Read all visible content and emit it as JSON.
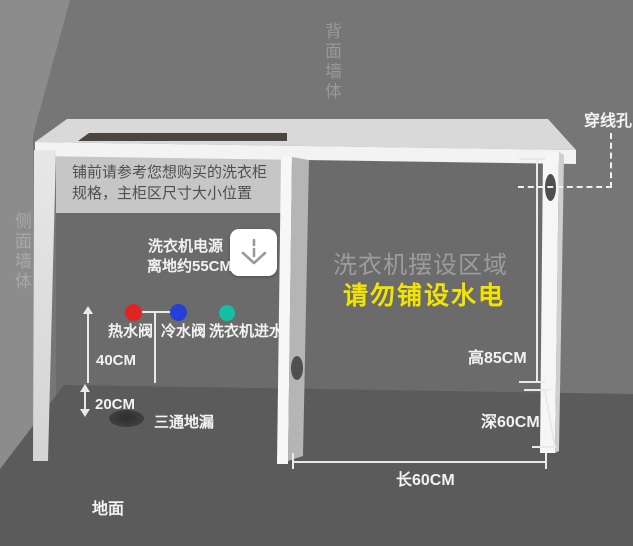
{
  "walls": {
    "back_label": "背面墙体",
    "side_label": "侧面墙体",
    "floor_label": "地面"
  },
  "notice": {
    "text": "铺前请参考您想购买的洗衣柜规格，主柜区尺寸大小位置"
  },
  "power": {
    "line1": "洗衣机电源",
    "line2": "离地约55CM",
    "icon": "plug-down-arrow-icon"
  },
  "valves": {
    "hot": {
      "label": "热水阀",
      "color": "#e02421"
    },
    "cold": {
      "label": "冷水阀",
      "color": "#2440d8"
    },
    "inlet": {
      "label": "洗衣机进水阀",
      "color": "#14bfa6"
    }
  },
  "drain": {
    "label": "三通地漏"
  },
  "area": {
    "title": "洗衣机摆设区域",
    "warning": "请勿铺设水电",
    "title_color": "#9c9c9c",
    "warning_color": "#f2e400"
  },
  "dimensions": {
    "height": "高85CM",
    "depth": "深60CM",
    "length": "长60CM",
    "valve_height": "40CM",
    "drain_offset": "20CM"
  },
  "wire_hole": {
    "label": "穿线孔"
  }
}
